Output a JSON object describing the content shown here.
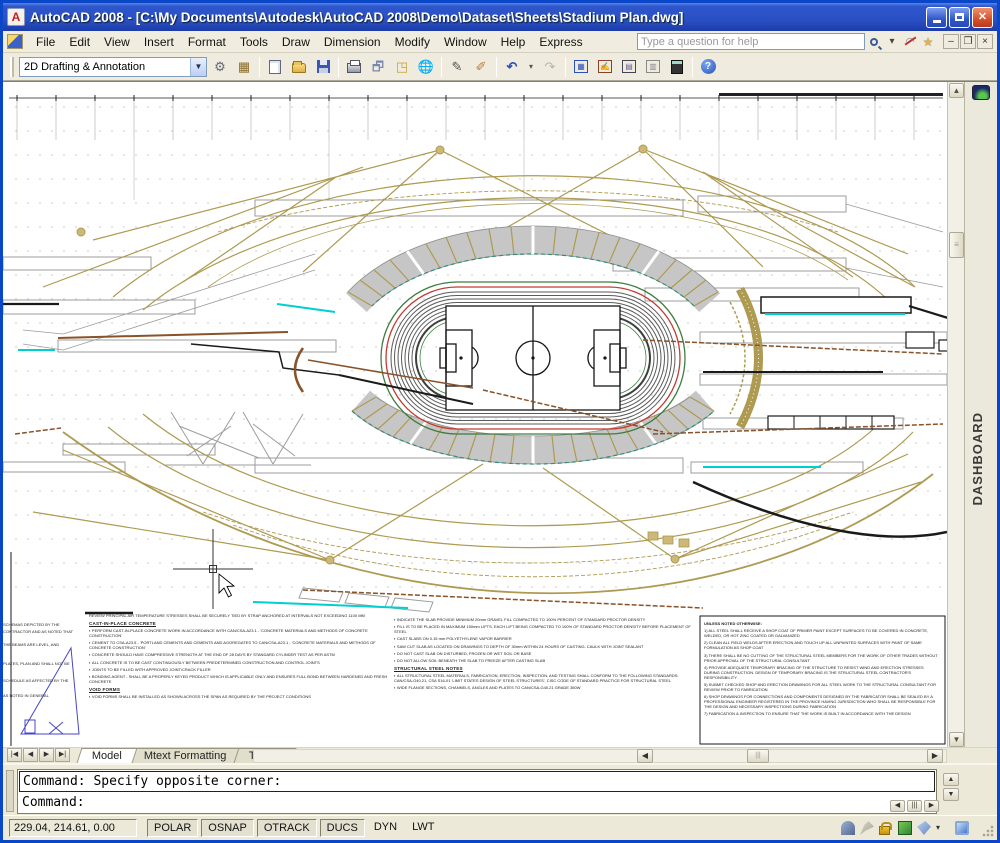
{
  "window": {
    "title": "AutoCAD 2008 - [C:\\My Documents\\Autodesk\\AutoCAD 2008\\Demo\\Dataset\\Sheets\\Stadium Plan.dwg]"
  },
  "menubar": {
    "items": [
      "File",
      "Edit",
      "View",
      "Insert",
      "Format",
      "Tools",
      "Draw",
      "Dimension",
      "Modify",
      "Window",
      "Help",
      "Express"
    ],
    "help_text": "Type a question for help"
  },
  "toolbar": {
    "workspace_label": "2D Drafting & Annotation",
    "icon_names": [
      "workspace-settings",
      "my-workspace",
      "qnew",
      "open",
      "save",
      "plot",
      "plot-preview",
      "publish",
      "3d-dwf",
      "match-properties",
      "block-editor",
      "undo",
      "redo",
      "sheet-set-manager",
      "markup-set-manager",
      "designcenter",
      "tool-palettes",
      "quickcalc",
      "help"
    ]
  },
  "drawing": {
    "dashboard_label": "DASHBOARD"
  },
  "layout_tabs": {
    "tabs": [
      "Model",
      "Mtext Formatting",
      "Tables"
    ]
  },
  "command_window": {
    "history_line": "Command: Specify opposite corner:",
    "input_line": "Command:"
  },
  "status_bar": {
    "coordinates": "229.04, 214.61, 0.00",
    "toggles": [
      {
        "label": "POLAR",
        "on": true
      },
      {
        "label": "OSNAP",
        "on": true
      },
      {
        "label": "OTRACK",
        "on": true
      },
      {
        "label": "DUCS",
        "on": true
      },
      {
        "label": "DYN",
        "on": false
      },
      {
        "label": "LWT",
        "on": false
      }
    ],
    "icon_names": [
      "communication-center",
      "annotation-scale",
      "toolbar-lock",
      "block-update",
      "annotation-tag",
      "status-menu-arrow",
      "clean-screen"
    ]
  },
  "notes": {
    "intro": "REVIEW PRINCIPAL AIR TEMPERATURE STRESSES SHALL BE SECURELY TIED BY STRAP ANCHORED AT INTERVALS NOT EXCEEDING 1100 MM",
    "left": {
      "heading": "CAST-IN-PLACE CONCRETE",
      "bullets": [
        "PERFORM CAST-IN-PLACE CONCRETE WORK IN ACCORDANCE WITH CAN/CSA-A23.1 - 'CONCRETE MATERIALS AND METHODS OF CONCRETE CONSTRUCTION'",
        "CEMENT TO CSA-A23.5 - 'PORTLAND CEMENTS AND CEMENTS AND AGGREGATES TO CAN/CSA-A23.1 - 'CONCRETE MATERIALS AND METHODS OF CONCRETE CONSTRUCTION'",
        "CONCRETE SHOULD HAVE COMPRESSIVE STRENGTH AT THE END OF 28 DAYS BY STANDARD CYLINDER TEST AS PER ASTM",
        "ALL CONCRETE IS TO BE CAST CONTINUOUSLY BETWEEN PREDETERMINED CONSTRUCTION AND CONTROL JOINTS",
        "JOINTS TO BE FILLED WITH APPROVED JOINT/CRACK FILLER",
        "BONDING AGENT - SHALL BE A PROPERLY KEYED PRODUCT WHICH IS APPLICABLE ONLY AND ENSURES FULL BOND BETWEEN HARDENED AND FRESH CONCRETE"
      ],
      "subheading": "VOID FORMS",
      "subbullet": "VOID FORMS SHALL BE INSTALLED AS SHOWN ACROSS THE SPAN AS REQUIRED BY THE PROJECT CONDITIONS"
    },
    "middle": {
      "bullets": [
        "INDICATE THE SLAB PROVIDE MINIMUM 20mm GRAVEL FILL COMPACTED TO 100% PERCENT OF STANDARD PROCTOR DENSITY",
        "FILL IS TO BE PLACED IN MAXIMUM 150mm LIFTS, EACH LIFT BEING COMPACTED TO 100% OF STANDARD PROCTOR DENSITY BEFORE PLACEMENT OF STEEL",
        "CAST SLABS ON 0.15 mm POLYETHYLENE VAPOR BARRIER",
        "SAW CUT SLAB AS LOCATED ON DRAWINGS TO DEPTH OF 30mm WITHIN 24 HOURS OF CASTING. CAULK WITH JOINT SEALANT",
        "DO NOT CAST SLAB ON DISTURBED, FROZEN OR WET SOIL OR BASE",
        "DO NOT ALLOW SOIL BENEATH THE SLAB TO FREEZE AFTER CASTING SLAB"
      ],
      "heading": "STRUCTURAL STEEL NOTES",
      "bullets2": [
        "ALL STRUCTURAL STEEL MATERIALS, FABRICATION, ERECTION, INSPECTION, AND TESTING SHALL CONFORM TO THE FOLLOWING STANDARDS: CAN/CSA-G40.21, CSA S16-01 'LIMIT STATES DESIGN OF STEEL STRUCTURES', CISC CODE OF STANDARD PRACTICE FOR STRUCTURAL STEEL",
        "WIDE FLANGE SECTIONS, CHANNELS, ANGLES AND PLATES TO CAN/CSA-G40.21 GRADE 350W"
      ]
    },
    "right": {
      "heading": "UNLESS NOTED OTHERWISE:",
      "items": [
        "1) ALL STEEL SHALL RECEIVE A SHOP COAT OF PRIMER PAINT EXCEPT SURFACES TO BE COVERED IN CONCRETE, WELDED, OR HOT ZINC COATED OR GALVANIZED",
        "2) CLEAN ALL FIELD WELDS AFTER ERECTION AND TOUCH UP ALL UNPAINTED SURFACES WITH PAINT OF SAME FORMULATION AS SHOP COAT",
        "3) THERE SHALL BE NO CUTTING OF THE STRUCTURAL STEEL MEMBERS FOR THE WORK OF OTHER TRADES WITHOUT PRIOR APPROVAL OF THE STRUCTURAL CONSULTANT",
        "4) PROVIDE ADEQUATE TEMPORARY BRACING OF THE STRUCTURE TO RESIST WIND AND ERECTION STRESSES DURING CONSTRUCTION. DESIGN OF TEMPORARY BRACING IS THE STRUCTURAL STEEL CONTRACTOR'S RESPONSIBILITY",
        "5) SUBMIT CHECKED SHOP AND ERECTION DRAWINGS FOR ALL STEEL WORK TO THE STRUCTURAL CONSULTANT FOR REVIEW PRIOR TO FABRICATION",
        "6) SHOP DRAWINGS FOR CONNECTIONS AND COMPONENTS DESIGNED BY THE FABRICATOR SHALL BE SEALED BY A PROFESSIONAL ENGINEER REGISTERED IN THE PROVINCE HAVING JURISDICTION WHO SHALL BE RESPONSIBLE FOR THE DESIGN AND NECESSARY INSPECTIONS DURING FABRICATION",
        "7) FABRICATION & INSPECTION TO ENSURE THAT THE WORK IS BUILT IN ACCORDANCE WITH THE DESIGN"
      ]
    },
    "clipped": [
      "SCHEMAS DEPICTED BY THE",
      "CONTRACTOR AND AS NOTED THAT",
      "THE BEAMS ARE LEVEL, AND",
      "PLATES, PLAN AND SHALL NOT BE",
      "SCHEDULE AS AFFECTED BY THE",
      "AS NOTED IN GENERAL"
    ]
  },
  "colors": {
    "khaki": "#AE9A50",
    "stand_gray": "#C6C6C6",
    "track_red": "#C23A32",
    "track_green": "#3E7D3E",
    "lane_gray": "#5A5A5A",
    "cyan": "#00CFCF",
    "brown": "#8A5228",
    "teal": "#2F8F78",
    "struct_gray": "#9C9C9C",
    "black": "#1A1A1A"
  }
}
